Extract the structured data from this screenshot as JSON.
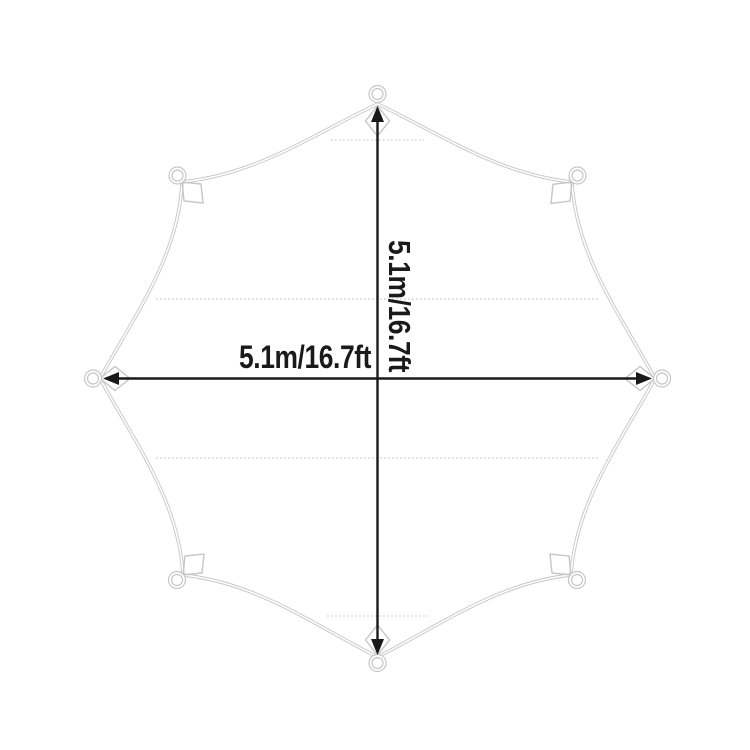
{
  "labels": {
    "width": "5.1m/16.7ft",
    "height": "5.1m/16.7ft"
  },
  "colors": {
    "background": "#ffffff",
    "outline": "#c6c6c6",
    "stitch": "#c9c9c9",
    "dimension": "#1a1a1a",
    "text": "#1a1a1a"
  }
}
